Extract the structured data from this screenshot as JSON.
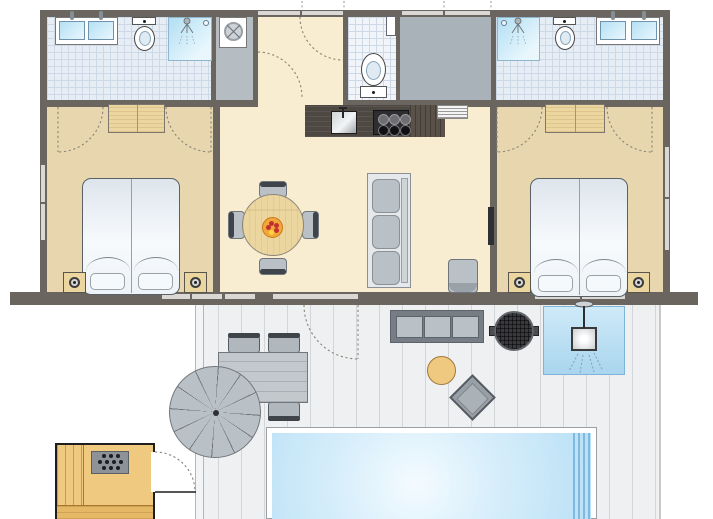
{
  "diagram": {
    "type": "floor-plan",
    "subject": "holiday-home-with-sauna-and-pool-deck",
    "orientation": "top-down",
    "visible_text": ""
  },
  "palette": {
    "wall": "#6b655f",
    "window": "#d9d8d4",
    "floor-bedroom": "#e8d7ae",
    "floor-living": "#f8edd0",
    "floor-bath": "#e7edf5",
    "floor-wc": "#f1f4f8",
    "tile-line": "#cdd9e7",
    "floor-laundry": "#b5bcc2",
    "floor-storage": "#a9b2b9",
    "wood": "#ecd6a0",
    "wood-border": "#7c766e",
    "furn-gray": "#b9c0c6",
    "furn-border": "#70767c",
    "seat-back": "#3f444a",
    "deck": "#eef0f1",
    "deck-line": "#d3d6d9",
    "water-a": "#f4fbff",
    "water-b": "#b9e0f6",
    "pool-step": "#7fb9de",
    "shower-a": "#b5e0f4",
    "shower-b": "#e9f7fd",
    "sauna-floor": "#eec97f",
    "sauna-line": "#c79b4e",
    "counter": "#4e4843",
    "counter-end": "#5a5149",
    "hob": "#2e2e30",
    "bed-a": "#dde5ec",
    "bed-b": "#f7fafc",
    "arc": "#8a8478",
    "white": "#ffffff"
  },
  "rooms": [
    {
      "id": "bathroom-left",
      "floor": "tile",
      "fixtures": [
        "double-washbasin",
        "toilet",
        "shower"
      ]
    },
    {
      "id": "laundry-closet",
      "floor": "vinyl",
      "fixtures": [
        "washing-machine"
      ]
    },
    {
      "id": "hallway",
      "floor": "laminate",
      "fixtures": [
        "entry-door-swing",
        "inner-door-swing"
      ]
    },
    {
      "id": "wc",
      "floor": "tile",
      "fixtures": [
        "toilet",
        "window"
      ]
    },
    {
      "id": "storage-room",
      "floor": "vinyl",
      "fixtures": []
    },
    {
      "id": "bathroom-right",
      "floor": "tile",
      "fixtures": [
        "shower",
        "toilet",
        "double-washbasin"
      ]
    },
    {
      "id": "bedroom-left",
      "floor": "laminate",
      "fixtures": [
        "wardrobe",
        "double-bed",
        "nightstand-left",
        "nightstand-right"
      ]
    },
    {
      "id": "living-kitchen",
      "floor": "laminate",
      "fixtures": [
        "kitchen-counter",
        "sink",
        "hob",
        "vent-grille",
        "dining-table",
        "dining-chairs",
        "fruit-bowl",
        "sofa",
        "armchair",
        "tv"
      ]
    },
    {
      "id": "bedroom-right",
      "floor": "laminate",
      "fixtures": [
        "wardrobe",
        "double-bed",
        "nightstand-left",
        "nightstand-right"
      ]
    },
    {
      "id": "sauna",
      "floor": "wood",
      "fixtures": [
        "sauna-stove",
        "benches",
        "door-swing"
      ]
    },
    {
      "id": "deck",
      "floor": "decking",
      "fixtures": [
        "outdoor-table",
        "outdoor-chairs",
        "parasol",
        "outdoor-sofa",
        "barbecue",
        "outdoor-shower",
        "stool",
        "side-table",
        "swimming-pool"
      ]
    }
  ],
  "kitchen": {
    "hob_burners": 6
  },
  "living": {
    "dining_chairs": 4,
    "sofa_cushions": 3,
    "fruit_dots": 5
  },
  "bedrooms": {
    "mattresses_per_bed": 2,
    "pillows_per_bed": 2,
    "nightstands_per_room": 2
  },
  "sauna": {
    "stone_rows": [
      3,
      4,
      3
    ]
  },
  "deck": {
    "outdoor_chairs": 4,
    "parasol_segments": 12,
    "sofa_cushions": 3,
    "pool_steps": 4
  }
}
